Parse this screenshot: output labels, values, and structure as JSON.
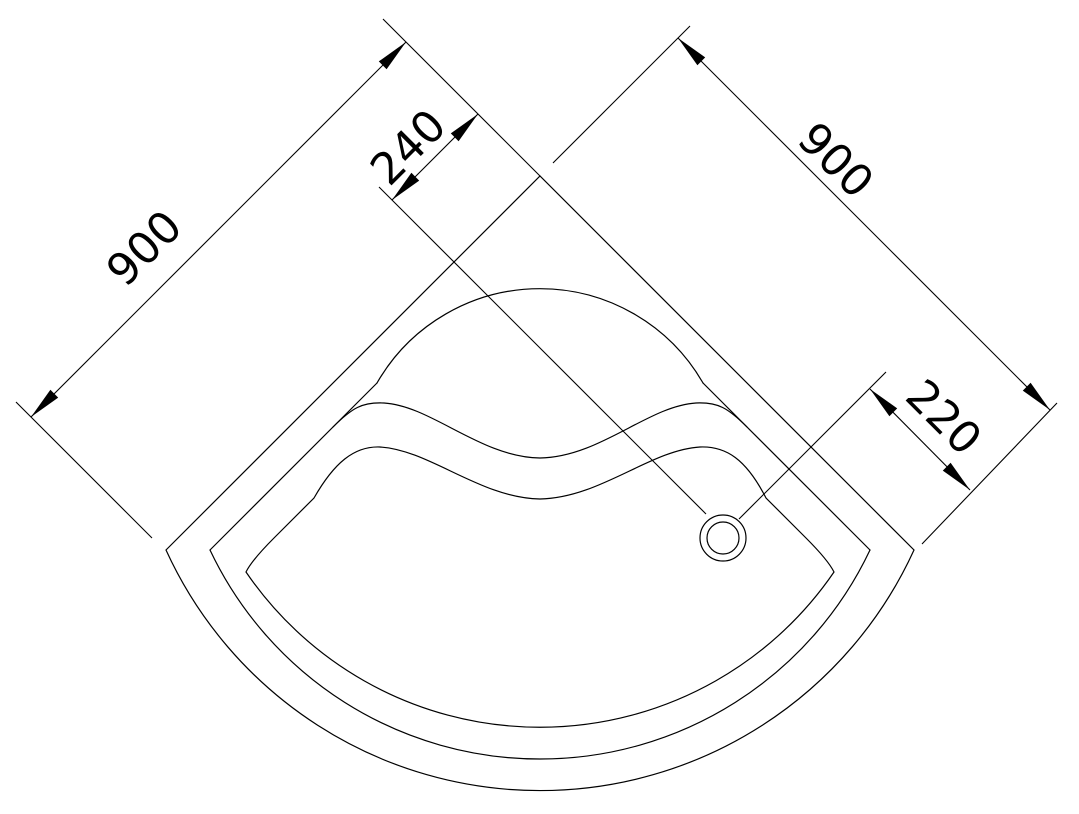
{
  "page": {
    "background_color": "#ffffff",
    "line_color": "#000000",
    "width": 1079,
    "height": 814
  },
  "dimensions": [
    {
      "name": "dimension-left-900",
      "label": "900",
      "rotation": -45,
      "label_x": 144,
      "label_y": 248,
      "lines": [
        [
          406,
          42,
          31,
          417
        ],
        [
          16,
          402,
          152,
          538
        ],
        [
          383,
          19,
          540,
          176
        ]
      ],
      "arrows": [
        {
          "tip": [
            406,
            42
          ],
          "dir": [
            1,
            -1
          ]
        },
        {
          "tip": [
            31,
            417
          ],
          "dir": [
            -1,
            1
          ]
        }
      ]
    },
    {
      "name": "dimension-240",
      "label": "240",
      "rotation": -45,
      "label_x": 408,
      "label_y": 147,
      "lines": [
        [
          392,
          200,
          478,
          114
        ],
        [
          379,
          187,
          706,
          514
        ]
      ],
      "arrows": [
        {
          "tip": [
            478,
            114
          ],
          "dir": [
            1,
            -1
          ]
        },
        {
          "tip": [
            392,
            200
          ],
          "dir": [
            -1,
            1
          ]
        }
      ]
    },
    {
      "name": "dimension-right-900",
      "label": "900",
      "rotation": 45,
      "label_x": 836,
      "label_y": 160,
      "lines": [
        [
          678,
          38,
          1050,
          410
        ],
        [
          553,
          163,
          690,
          26
        ],
        [
          922,
          544,
          1057,
          403
        ]
      ],
      "arrows": [
        {
          "tip": [
            678,
            38
          ],
          "dir": [
            -1,
            -1
          ]
        },
        {
          "tip": [
            1050,
            410
          ],
          "dir": [
            1,
            1
          ]
        }
      ]
    },
    {
      "name": "dimension-220",
      "label": "220",
      "rotation": 45,
      "label_x": 944,
      "label_y": 417,
      "lines": [
        [
          870,
          389,
          970,
          490
        ],
        [
          739,
          519,
          886,
          372
        ]
      ],
      "arrows": [
        {
          "tip": [
            870,
            389
          ],
          "dir": [
            -1,
            -1
          ]
        },
        {
          "tip": [
            970,
            490
          ],
          "dir": [
            1,
            1
          ]
        }
      ]
    }
  ],
  "drawing": {
    "arrow_length": 33,
    "arrow_half_width": 5.5,
    "outlines": [
      {
        "name": "tray-outer-edge",
        "d": "M 166,550 L 540,176 L 914,550 A 411,411 0 0 1 166,550 Z"
      },
      {
        "name": "tray-rim-left-edge",
        "d": "M 210,550 L 377,383"
      },
      {
        "name": "tray-rim-right-edge",
        "d": "M 870,550 L 703,383"
      },
      {
        "name": "tray-rim-front-arc",
        "d": "M 210,550 A 365,365 0 0 0 870,550"
      },
      {
        "name": "seat-back-arc",
        "d": "M 377,383 A 188,188 0 0 1 703,383"
      },
      {
        "name": "seat-front-upper-curve",
        "d": "M 333,427 C 352,408 362,402 384,403 C 432,406 480,457 540,458 C 600,457 648,406 696,403 C 718,402 728,408 747,427"
      },
      {
        "name": "bowl-inner-outline",
        "d": "M 314,498 C 334,463 354,446 380,447 C 430,450 480,498 540,499 C 600,498 650,450 700,447 C 726,446 746,459 766,498 L 806,538 Q 828,560 834,572 A 356,356 0 0 1 246,572 Q 252,560 274,538 Z"
      }
    ],
    "drain": {
      "cx": 723,
      "cy": 538,
      "r_outer": 23,
      "r_inner": 16
    }
  }
}
